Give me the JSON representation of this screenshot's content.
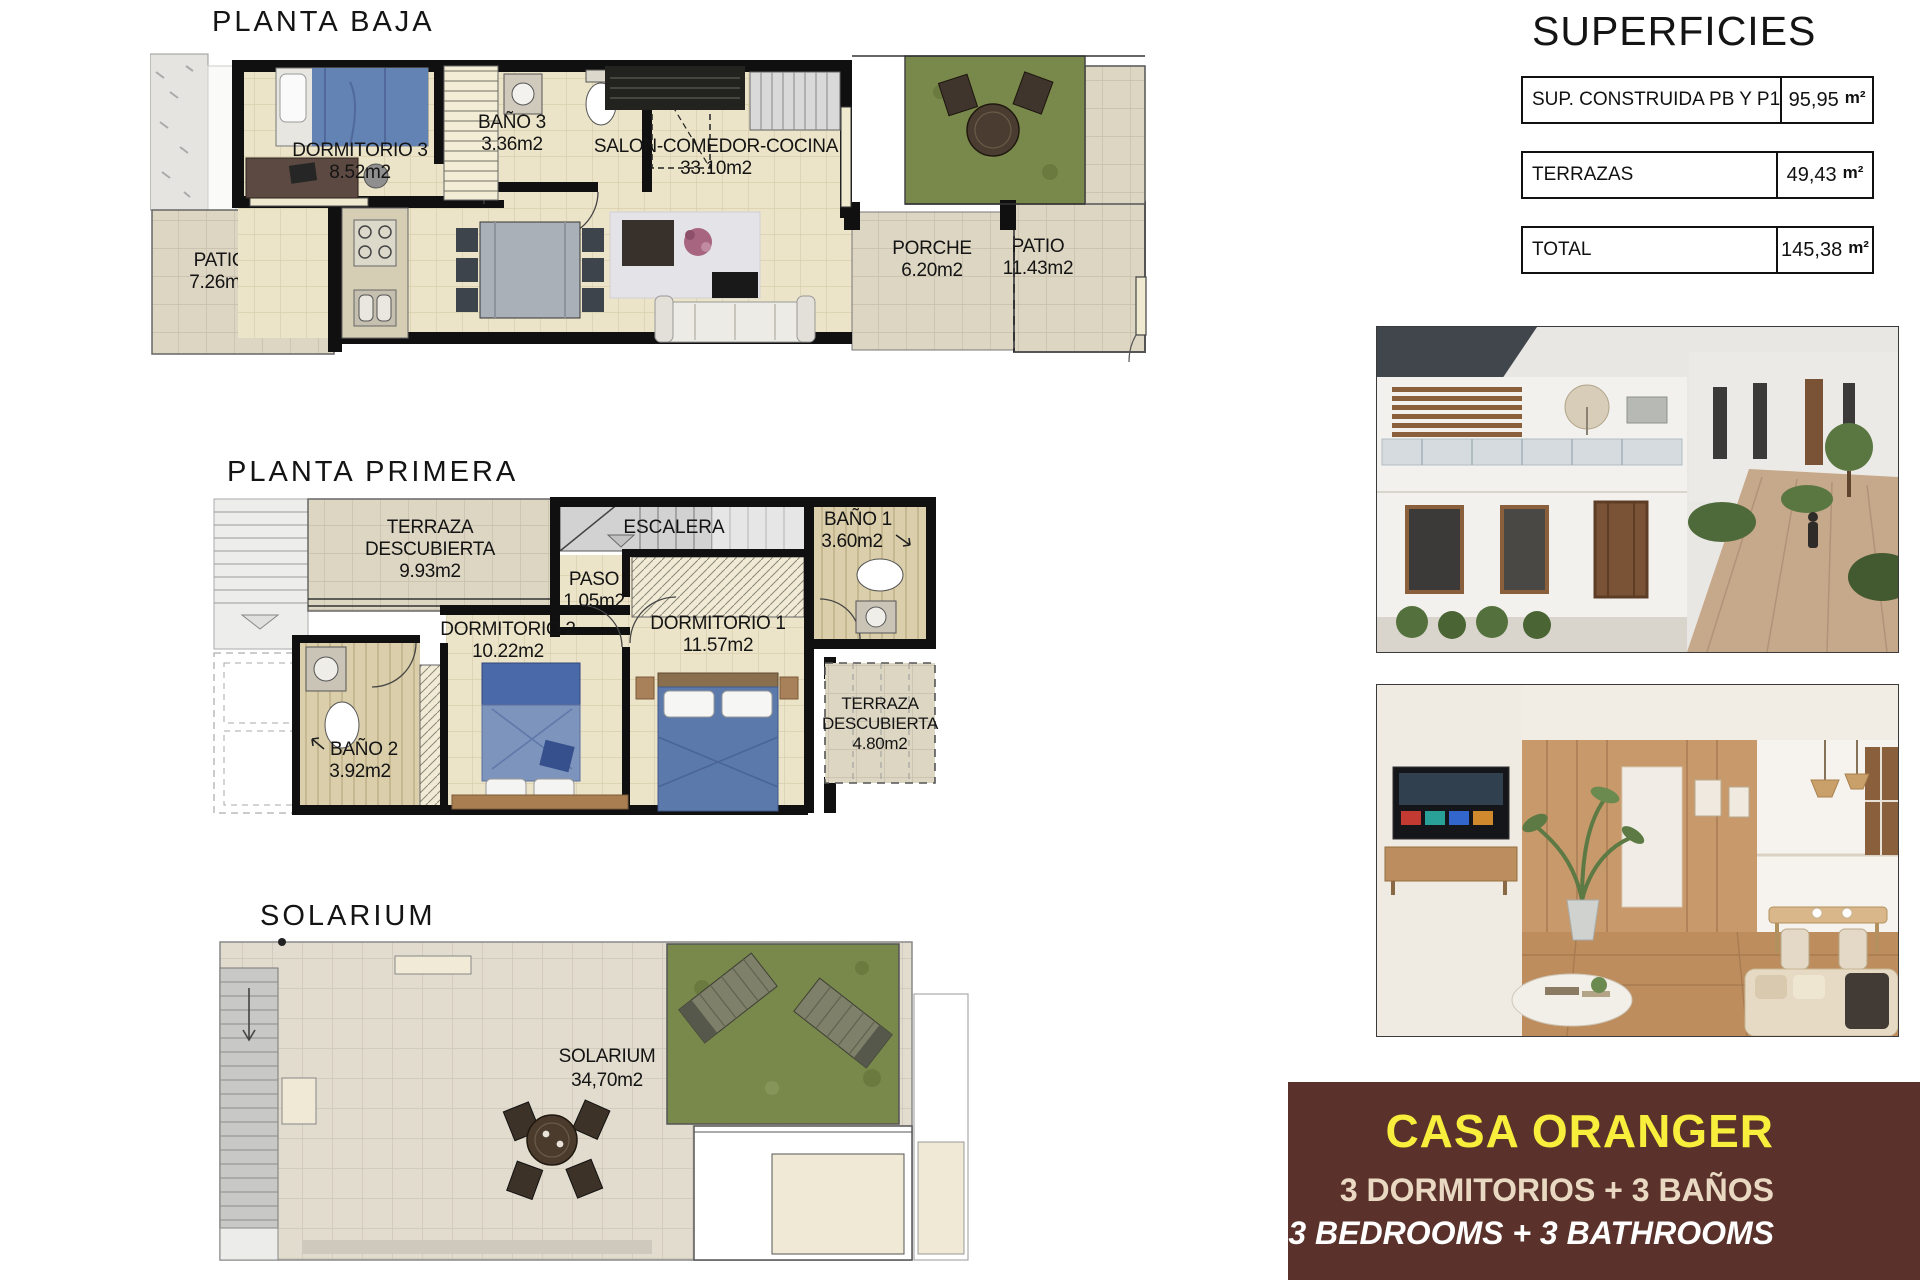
{
  "planta_baja": {
    "title": "PLANTA BAJA",
    "dormitorio3": {
      "name": "DORMITORIO 3",
      "area": "8.52m2"
    },
    "bano3": {
      "name": "BAÑO 3",
      "area": "3.36m2"
    },
    "salon": {
      "name": "SALON-COMEDOR-COCINA",
      "area": "33.10m2"
    },
    "patio_left": {
      "name": "PATIO",
      "area": "7.26m2"
    },
    "porche": {
      "name": "PORCHE",
      "area": "6.20m2"
    },
    "patio_right": {
      "name": "PATIO",
      "area": "11.43m2"
    }
  },
  "planta_primera": {
    "title": "PLANTA PRIMERA",
    "terraza1": {
      "name1": "TERRAZA",
      "name2": "DESCUBIERTA",
      "area": "9.93m2"
    },
    "escalera": {
      "name": "ESCALERA"
    },
    "bano1": {
      "name": "BAÑO 1",
      "area": "3.60m2"
    },
    "paso": {
      "name": "PASO",
      "area": "1.05m2"
    },
    "dormitorio2": {
      "name": "DORMITORIO 2",
      "area": "10.22m2"
    },
    "dormitorio1": {
      "name": "DORMITORIO 1",
      "area": "11.57m2"
    },
    "bano2": {
      "name": "BAÑO 2",
      "area": "3.92m2"
    },
    "terraza2": {
      "name1": "TERRAZA",
      "name2": "DESCUBIERTA",
      "area": "4.80m2"
    }
  },
  "solarium": {
    "title": "SOLARIUM",
    "room": {
      "name": "SOLARIUM",
      "area": "34,70m2"
    }
  },
  "superficies": {
    "title": "SUPERFICIES",
    "rows": [
      {
        "label": "SUP. CONSTRUIDA PB Y P1",
        "value": "95,95",
        "unit": "m²"
      },
      {
        "label": "TERRAZAS",
        "value": "49,43",
        "unit": "m²"
      },
      {
        "label": "TOTAL",
        "value": "145,38",
        "unit": "m²"
      }
    ]
  },
  "property": {
    "name": "CASA ORANGER",
    "subtitle_es": "3 DORMITORIOS + 3 BAÑOS",
    "subtitle_en": "3 BEDROOMS + 3 BATHROOMS"
  },
  "colors": {
    "brand_brown": "#5a322b",
    "brand_yellow": "#f8ee3c",
    "brand_beige": "#e9d9c2",
    "floor_beige": "#ece4c8",
    "patio_tile": "#ddd6c3",
    "grass_green": "#79894c",
    "wall_black": "#101010",
    "bed_blue": "#6383b5"
  }
}
